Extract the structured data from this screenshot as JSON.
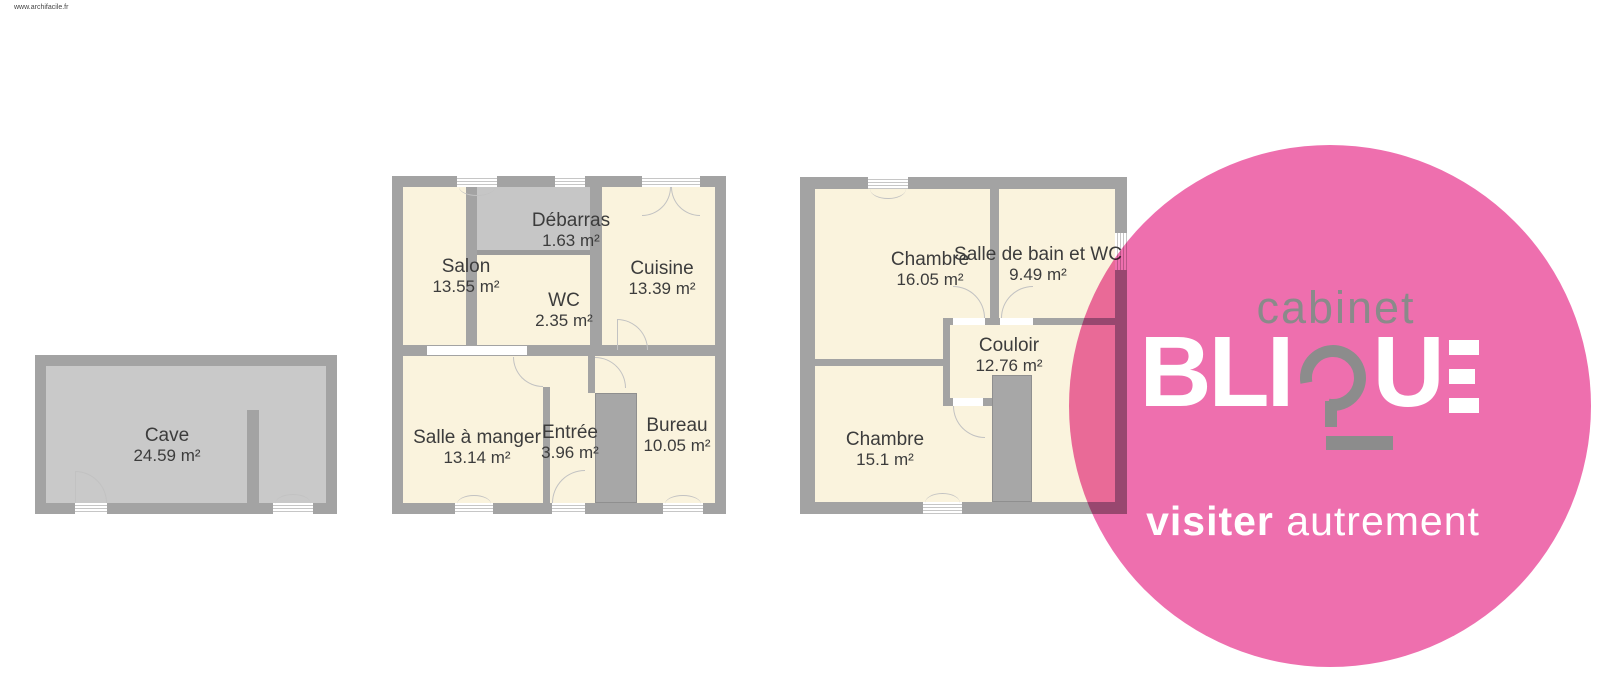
{
  "watermark": "www.archifacile.fr",
  "colors": {
    "brand_pink": "#ee6fae",
    "wall_gray": "#a3a3a3",
    "room_cream": "#faf3dd",
    "cave_floor_gray": "#c9c9c9",
    "debarras_floor_gray": "#c6c6c6",
    "label_text": "#3c3c3c",
    "logo_gray": "#8a8a8a"
  },
  "plans": {
    "cave": {
      "rooms": [
        {
          "name": "Cave",
          "area": "24.59 m²"
        }
      ]
    },
    "ground": {
      "rooms": [
        {
          "name": "Salon",
          "area": "13.55 m²"
        },
        {
          "name": "Débarras",
          "area": "1.63 m²"
        },
        {
          "name": "WC",
          "area": "2.35 m²"
        },
        {
          "name": "Cuisine",
          "area": "13.39 m²"
        },
        {
          "name": "Salle à manger",
          "area": "13.14 m²"
        },
        {
          "name": "Entrée",
          "area": "3.96 m²"
        },
        {
          "name": "Bureau",
          "area": "10.05 m²"
        }
      ]
    },
    "first": {
      "rooms": [
        {
          "name": "Chambre",
          "area": "16.05 m²"
        },
        {
          "name": "Salle de bain et WC",
          "area": "9.49 m²"
        },
        {
          "name": "Couloir",
          "area": "12.76 m²"
        },
        {
          "name": "Chambre",
          "area": "15.1 m²"
        }
      ]
    }
  },
  "logo": {
    "top": "cabinet",
    "brand_full": "BLIQUE",
    "brand_left": "BLI",
    "brand_u": "U",
    "tagline_bold": "visiter",
    "tagline_light": "autrement"
  }
}
